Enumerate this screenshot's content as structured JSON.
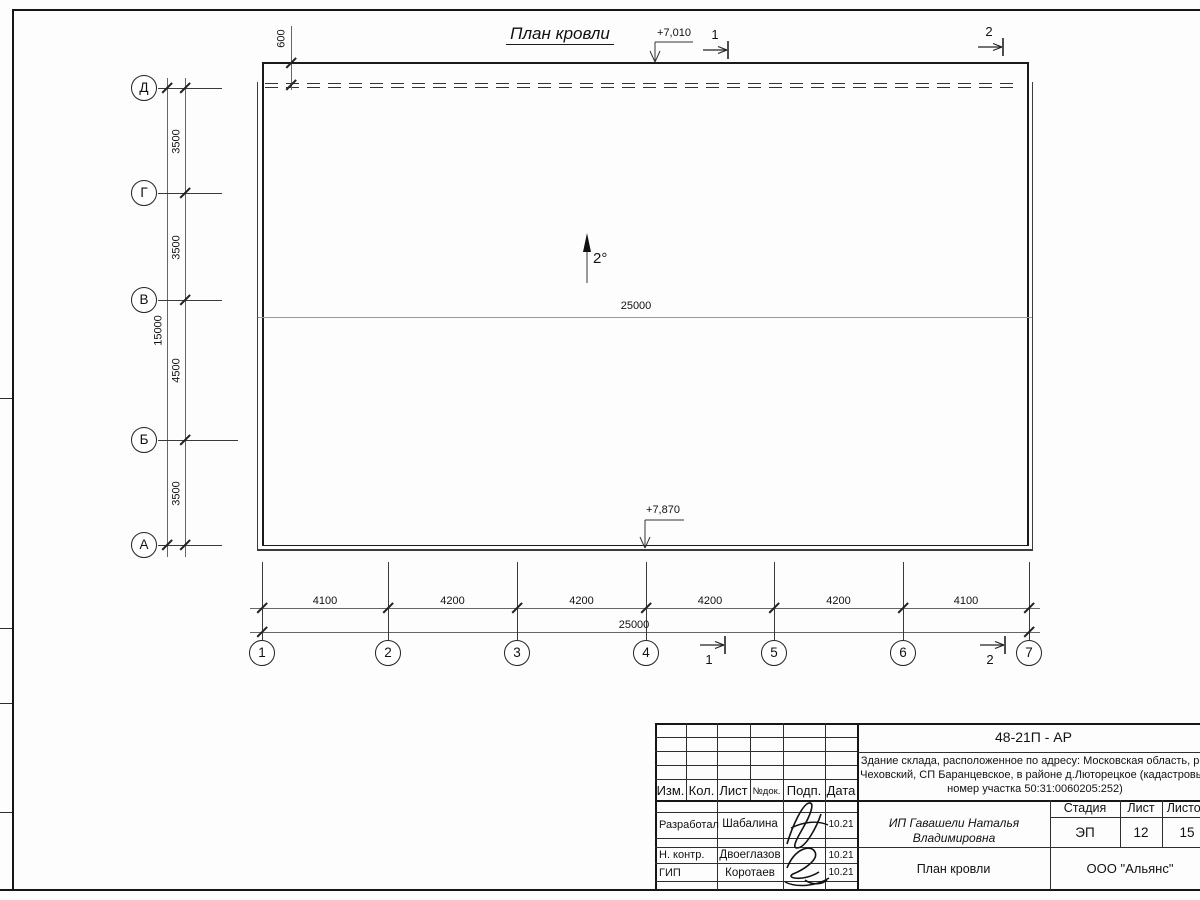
{
  "drawing": {
    "title": "План кровли",
    "slope": "2°",
    "elevation_top": "+7,010",
    "elevation_bottom": "+7,870",
    "parapet_offset": "600",
    "ridge_length": "25000"
  },
  "axes_vertical": {
    "labels": [
      "Д",
      "Г",
      "В",
      "Б",
      "А"
    ],
    "dims": [
      "3500",
      "3500",
      "4500",
      "3500"
    ],
    "total": "15000"
  },
  "axes_horizontal": {
    "labels": [
      "1",
      "2",
      "3",
      "4",
      "5",
      "6",
      "7"
    ],
    "dims": [
      "4100",
      "4200",
      "4200",
      "4200",
      "4200",
      "4100"
    ],
    "total": "25000"
  },
  "section_marks": {
    "one": "1",
    "two": "2"
  },
  "title_block": {
    "code": "48-21П - АР",
    "object_lines": [
      "Здание склада, расположенное по адресу: Московская область, р-н",
      "Чеховский, СП Баранцевское, в районе д.Люторецкое  (кадастровый",
      "номер участка 50:31:0060205:252)"
    ],
    "rev_headers": [
      "Изм.",
      "Кол.",
      "Лист",
      "№док.",
      "Подп.",
      "Дата"
    ],
    "signers": [
      {
        "role": "Разработал",
        "name": "Шабалина",
        "date": "10.21"
      },
      {
        "role": "Н. контр.",
        "name": "Двоеглазов",
        "date": "10.21"
      },
      {
        "role": "ГИП",
        "name": "Коротаев",
        "date": "10.21"
      }
    ],
    "client": "ИП Гавашели Наталья Владимировна",
    "stage_headers": [
      "Стадия",
      "Лист",
      "Листов"
    ],
    "stage": "ЭП",
    "sheet": "12",
    "sheets": "15",
    "sheet_title": "План кровли",
    "company": "ООО \"Альянс\""
  }
}
